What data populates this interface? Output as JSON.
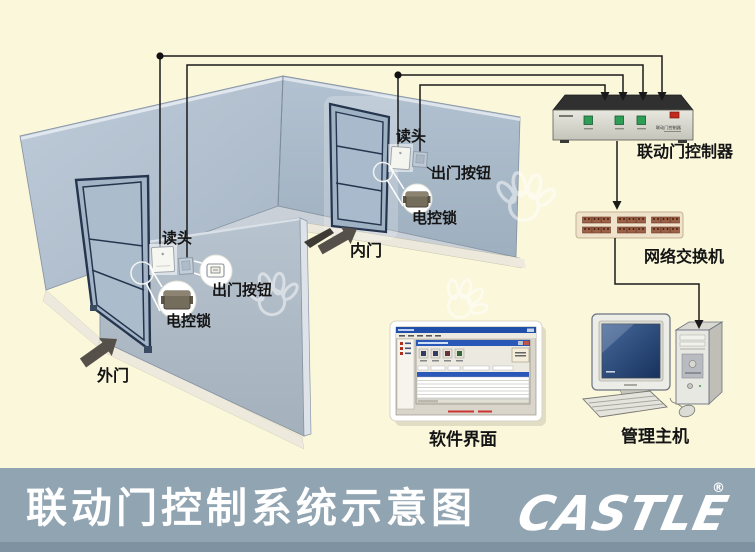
{
  "diagram": {
    "outer_door": {
      "reader": "读头",
      "exit_button": "出门按钮",
      "lock": "电控锁",
      "name": "外门"
    },
    "inner_door": {
      "reader": "读头",
      "exit_button": "出门按钮",
      "lock": "电控锁",
      "name": "内门"
    },
    "controller": {
      "label": "联动门控制器",
      "panel_print": "联动门控制器"
    },
    "network_switch": {
      "label": "网络交换机"
    },
    "software": {
      "label": "软件界面"
    },
    "host": {
      "label": "管理主机"
    }
  },
  "footer": {
    "title": "联动门控制系统示意图",
    "logo_text": "CASTLE",
    "registered_mark": "®"
  },
  "colors": {
    "background": "#FAF7DB",
    "footer_bar": "#91A4B2",
    "footer_bar_dark": "#7E92A1",
    "wall": "#B4C2D2",
    "floor": "#C9D0D8",
    "door_outline": "#26354E",
    "wire": "#1A1A1A",
    "button_green": "#2E9E57",
    "indicator_red": "#C3291E",
    "switch_body": "#F0E3CC",
    "arrow_dark": "#56504A"
  }
}
